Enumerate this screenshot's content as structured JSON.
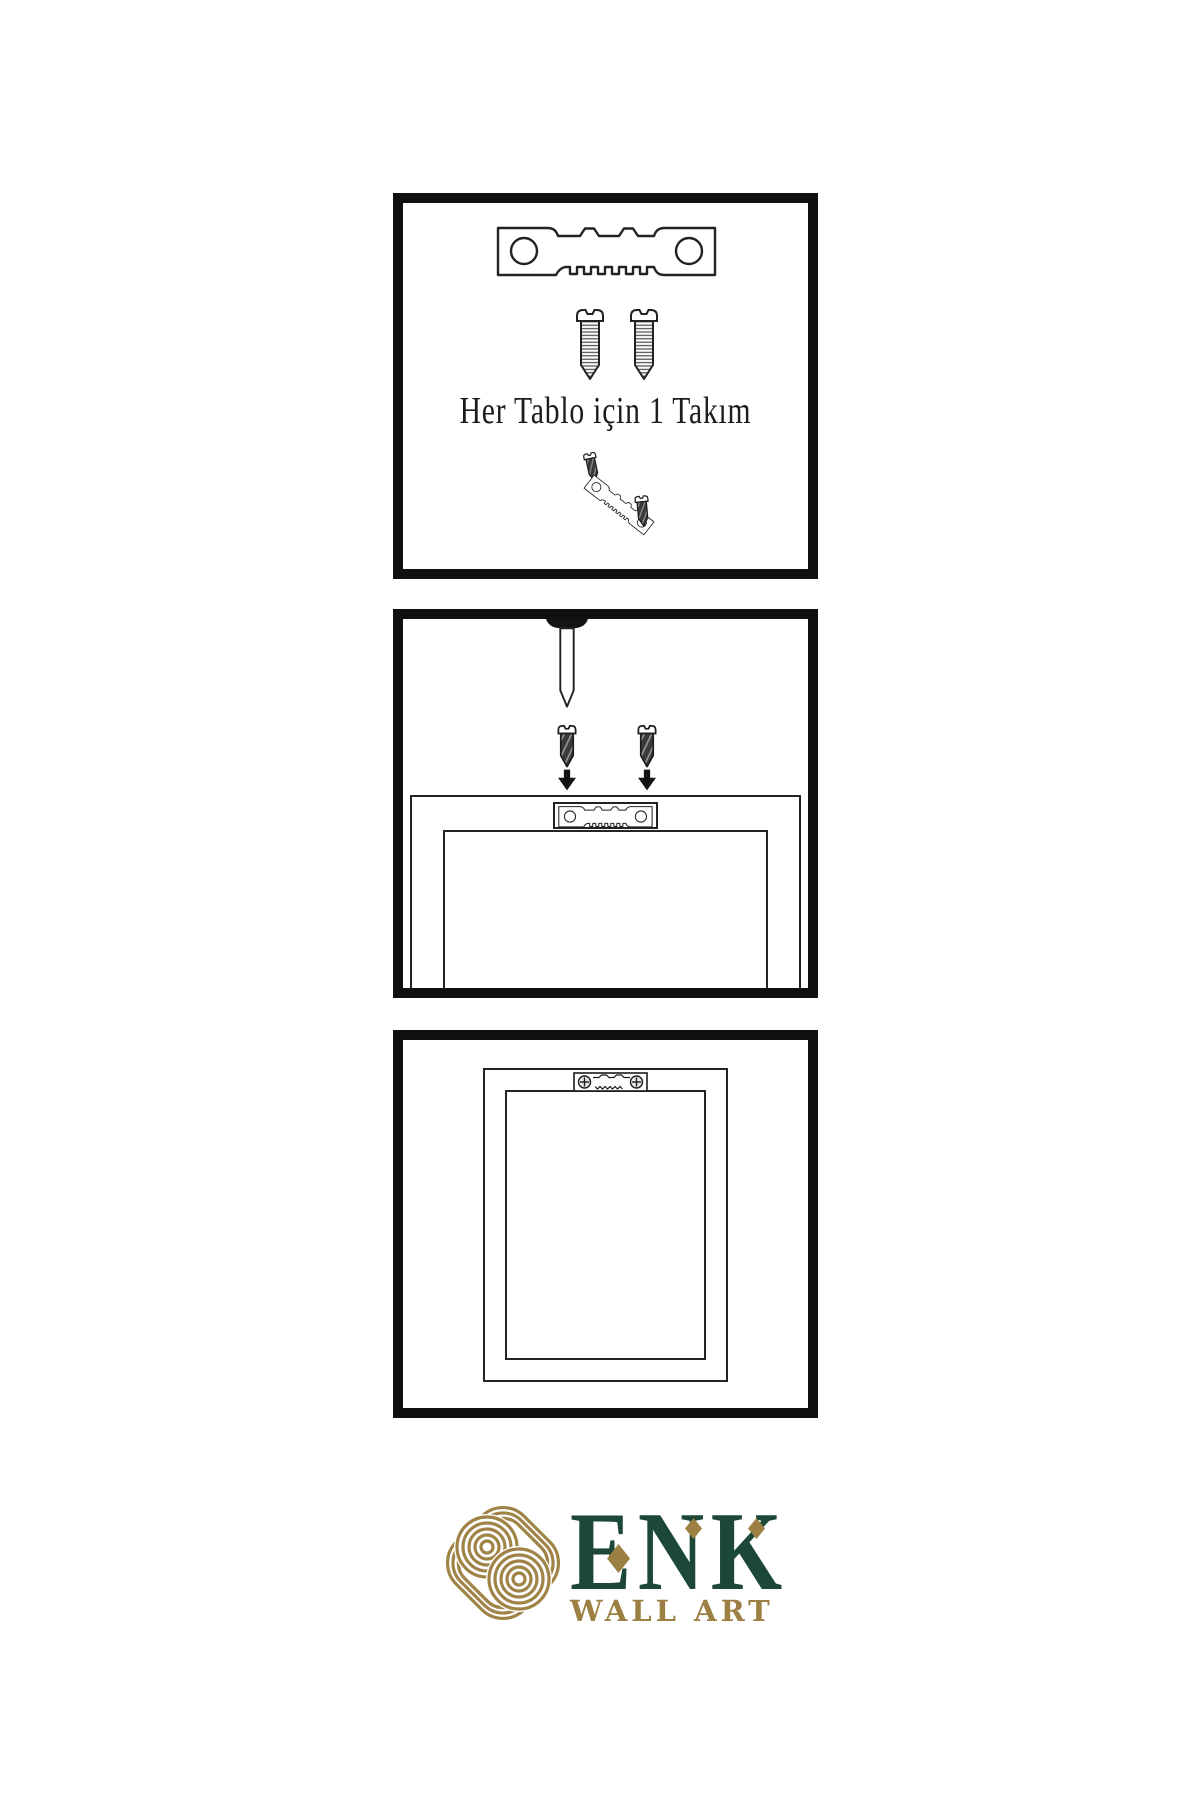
{
  "instructions": {
    "step1_caption": "Her Tablo için 1 Takım"
  },
  "branding": {
    "name": "ENK",
    "subtitle": "WALL ART",
    "name_color": "#1d4737",
    "gold_color": "#9c7f42"
  },
  "colors": {
    "background": "#ffffff",
    "line_ink": "#222222",
    "panel_border": "#101010",
    "screw_dark_fill": "#3b3b3b"
  },
  "icons": {
    "sawtooth_hanger": "sawtooth-hanger-icon",
    "screw": "screw-icon",
    "dark_screw": "dark-screw-icon",
    "nail": "wall-nail-icon",
    "down_arrow": "down-arrow-icon",
    "phillips_hanger": "mounted-hanger-icon",
    "knot_logo": "knot-logo-icon",
    "diamond_accent": "diamond-accent-icon"
  }
}
